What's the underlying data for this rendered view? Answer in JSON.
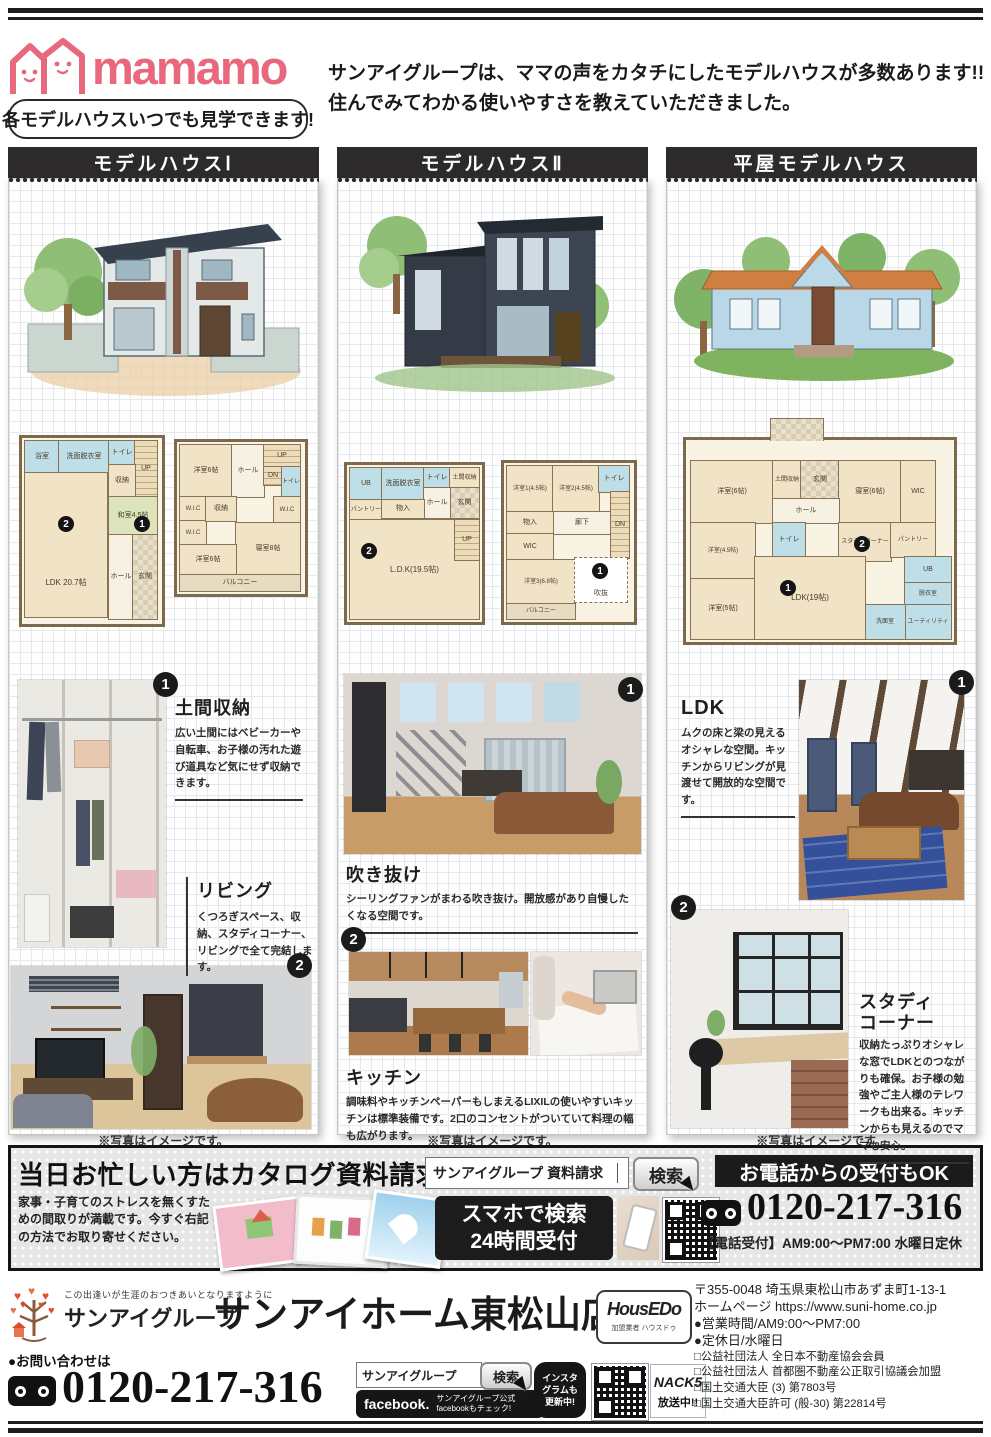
{
  "header": {
    "brand": "mamamo",
    "brand_badge": "各モデルハウスいつでも見学できます!",
    "intro_line1": "サンアイグループは、ママの声をカタチにしたモデルハウスが多数あります!!",
    "intro_line2": "住んでみてわかる使いやすさを教えていただきました。"
  },
  "columns": [
    {
      "title": "モデルハウスⅠ",
      "note": "※写真はイメージです。",
      "features": [
        {
          "num": "1",
          "title": "土間収納",
          "desc": "広い土間にはベビーカーや自転車、お子様の汚れた遊び道具など気にせず収納できます。"
        },
        {
          "num": "2",
          "title": "リビング",
          "desc": "くつろぎスペース、収納、スタディコーナー、リビングで全て完結します。"
        }
      ],
      "plan1": {
        "bath": "浴室",
        "wash": "洗面脱衣室",
        "toilet": "トイレ",
        "up": "UP",
        "sto": "収納",
        "washitsu": "和室4.5帖",
        "ldk": "LDK 20.7帖",
        "hall": "ホール",
        "ent": "玄関",
        "b1": "1",
        "b2": "2"
      },
      "plan2": {
        "y1": "洋室6帖",
        "hall": "ホール",
        "up": "UP",
        "dn": "DN",
        "toilet": "トイレ",
        "wic1": "W.I.C",
        "wic2": "W.I.C",
        "sto": "収納",
        "wic3": "W.I.C",
        "bed": "寝室8帖",
        "y2": "洋室6帖",
        "bal": "バルコニー"
      }
    },
    {
      "title": "モデルハウスⅡ",
      "note": "※写真はイメージです。",
      "features": [
        {
          "num": "1",
          "title": "吹き抜け",
          "desc": "シーリングファンがまわる吹き抜け。開放感があり自慢したくなる空間です。"
        },
        {
          "num": "2",
          "title": "キッチン",
          "desc": "調味料やキッチンペーパーもしまえるLIXILの使いやすいキッチンは標準装備です。2口のコンセントがついていて料理の幅も広がります。"
        }
      ],
      "plan1": {
        "ub": "UB",
        "wash": "洗面脱衣室",
        "toilet": "トイレ",
        "doma": "土間収納",
        "ent": "玄関",
        "pan": "パントリー",
        "hall": "ホール",
        "mono": "物入",
        "ldk": "L.D.K(19.5帖)",
        "up": "UP",
        "b2": "2"
      },
      "plan2": {
        "y1": "洋室1(4.5帖)",
        "y2": "洋室2(4.5帖)",
        "toilet": "トイレ",
        "roka": "廊下",
        "dn": "DN",
        "mono": "物入",
        "wic": "WIC",
        "y3": "洋室3(6.8帖)",
        "void": "吹抜",
        "bal": "バルコニー",
        "b1": "1"
      }
    },
    {
      "title": "平屋モデルハウス",
      "note": "※写真はイメージです。",
      "features": [
        {
          "num": "1",
          "title": "LDK",
          "desc": "ムクの床と梁の見えるオシャレな空間。キッチンからリビングが見渡せて開放的な空間です。"
        },
        {
          "num": "2",
          "title": "スタディコーナー",
          "desc": "収納たっぷりオシャレな窓でLDKとのつながりも確保。お子様の勉強やご主人様のテレワークも出来る。キッチンからも見えるのでママも安心。"
        }
      ],
      "plan": {
        "y6": "洋室(6帖)",
        "doma": "土間収納",
        "ent": "玄関",
        "bed": "寝室(6帖)",
        "wic": "WIC",
        "hall": "ホール",
        "toilet": "トイレ",
        "study": "スタディコーナー",
        "pan": "パントリー",
        "ub": "UB",
        "y45": "洋室(4.5帖)",
        "datsui": "脱衣室",
        "senmen": "洗面室",
        "ldk": "LDK(19帖)",
        "y5": "洋室(5帖)",
        "util": "ユーティリティ",
        "b1": "1",
        "b2": "2"
      }
    }
  ],
  "catalog": {
    "title": "当日お忙しい方はカタログ資料請求",
    "search_value": "サンアイグループ 資料請求",
    "search_button": "検索",
    "phone_header": "お電話からの受付もOK",
    "phone_number": "0120-217-316",
    "phone_hours": "【電話受付】AM9:00～PM7:00 水曜日定休",
    "desc": "家事・子育てのストレスを無くすための間取りが満載です。今すぐ右記の方法でお取り寄せください。",
    "smart_line1": "スマホで検索",
    "smart_line2": "24時間受付"
  },
  "footer": {
    "tagline": "この出逢いが生涯のおつきあいとなりますように",
    "group_name": "サンアイグループ",
    "store_name": "サンアイホーム東松山店",
    "housedo_name": "HousEDo",
    "housedo_sub": "加盟業者 ハウスドゥ",
    "contact_label": "●お問い合わせは",
    "phone_number": "0120-217-316",
    "search_value": "サンアイグループ",
    "search_button": "検索",
    "facebook_brand": "facebook.",
    "facebook_line1": "サンアイグループ公式",
    "facebook_line2": "facebookもチェック!",
    "insta_line1": "インスタ",
    "insta_line2": "グラムも",
    "insta_line3": "更新中!",
    "nack_name": "NACK5",
    "nack_sub": "放送中!!",
    "address_lines": [
      "〒355-0048 埼玉県東松山市あずま町1-13-1",
      "ホームページ https://www.suni-home.co.jp",
      "●営業時間/AM9:00～PM7:00",
      "●定休日/水曜日",
      "□公益社団法人 全日本不動産協会会員",
      "□公益社団法人 首都圏不動産公正取引協議会加盟",
      "□国土交通大臣 (3) 第7803号",
      "□国土交通大臣許可 (般-30) 第22814号"
    ]
  }
}
